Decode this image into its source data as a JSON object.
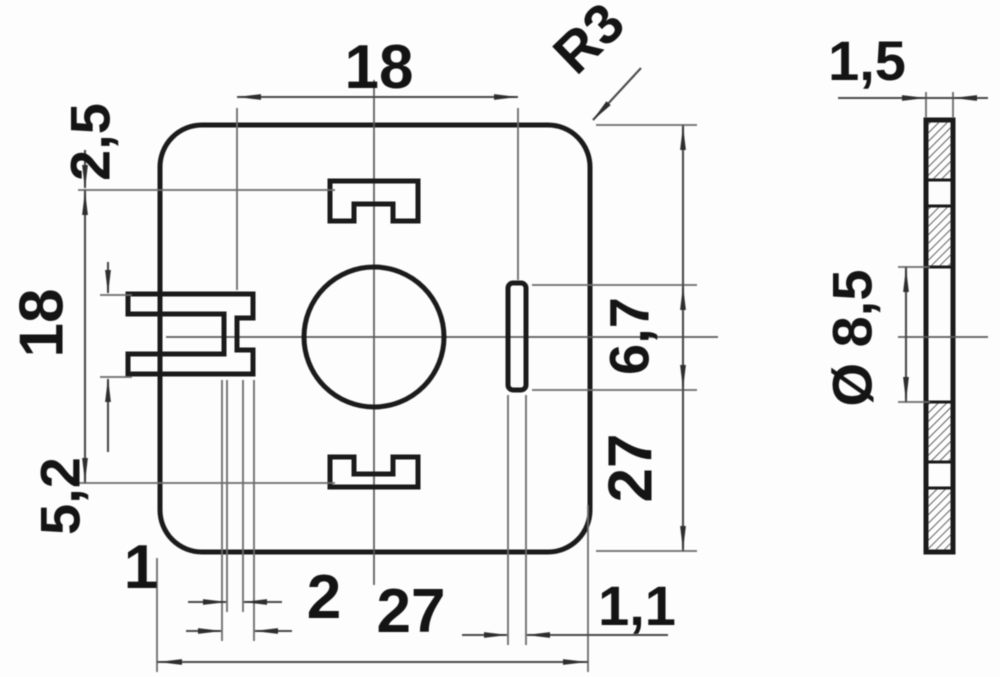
{
  "drawing": {
    "kind": "technical dimension drawing",
    "views": {
      "front": "square mounting plate with rounded corners, center hole, top and bottom bayonet slots, left keyway, right coding slot",
      "side": "hatched cross-section of thin plate"
    },
    "colors": {
      "background": "#fdfdfd",
      "object_line": "#1b1b1b",
      "dimension_line": "#4a4a4a"
    },
    "dimensions": {
      "lug_span_top": "18",
      "corner_radius": "R3",
      "plate_thickness": "1,5",
      "slot_height": "2,5",
      "lug_span_left": "18",
      "keyway_height": "5,2",
      "key_width": "1",
      "key_depth": "2",
      "plate_width": "27",
      "plate_height": "27",
      "coding_slot_width": "1,1",
      "coding_slot_height": "6,7",
      "hole_diameter": "Ø 8,5"
    }
  }
}
